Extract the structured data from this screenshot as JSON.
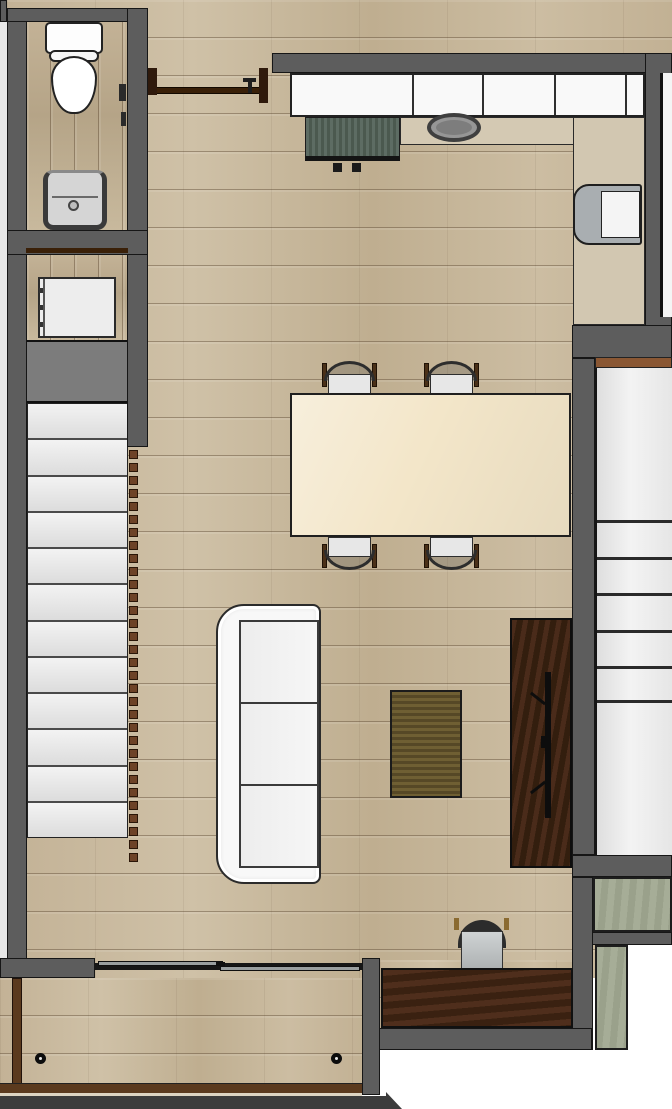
{
  "meta": {
    "label": "Apartment floor plan — top-down rendered view",
    "type": "floor-plan"
  },
  "colors": {
    "wall": "#5d5d5d",
    "wall_outline": "#161616",
    "floor_wood": "#c9baa0",
    "stair_tread": "#e9e9e9",
    "stair_landing": "#7c7c7c",
    "baluster_brown": "#6d4227",
    "door_wood_brown": "#3a2008",
    "kitchen_cabinet_white": "#f9f9f9",
    "counter_beige": "#d4c9b3",
    "cooktop_green": "#56655c",
    "fridge_gray": "#a9aeb1",
    "dining_table_cream": "#f3e6c9",
    "sofa_white": "#f6f6f6",
    "coffee_table_olive": "#60522a",
    "tv_console_walnut": "#42281a",
    "desk_walnut": "#47291a",
    "concrete_green": "#a6ad97",
    "balcony_trim_brown": "#5b3a1e",
    "headboard_brown": "#8a5733",
    "sliding_door_gray": "#999e9f"
  },
  "stairs": {
    "tread_count": 12,
    "baluster_count": 32,
    "baluster_spacing": 13
  },
  "kitchen": {
    "cabinet_divider_x": [
      120,
      190,
      262,
      333
    ]
  },
  "adjacent_room": {
    "panel_line_y": [
      152,
      189,
      225,
      262,
      298,
      332
    ]
  },
  "dining": {
    "chairs": [
      {
        "x": 322,
        "row": "top"
      },
      {
        "x": 424,
        "row": "top"
      },
      {
        "x": 322,
        "row": "bottom"
      },
      {
        "x": 424,
        "row": "bottom"
      }
    ]
  },
  "sofa": {
    "cushion_count": 3
  },
  "balcony": {
    "spotlight_x": [
      35,
      331
    ]
  }
}
